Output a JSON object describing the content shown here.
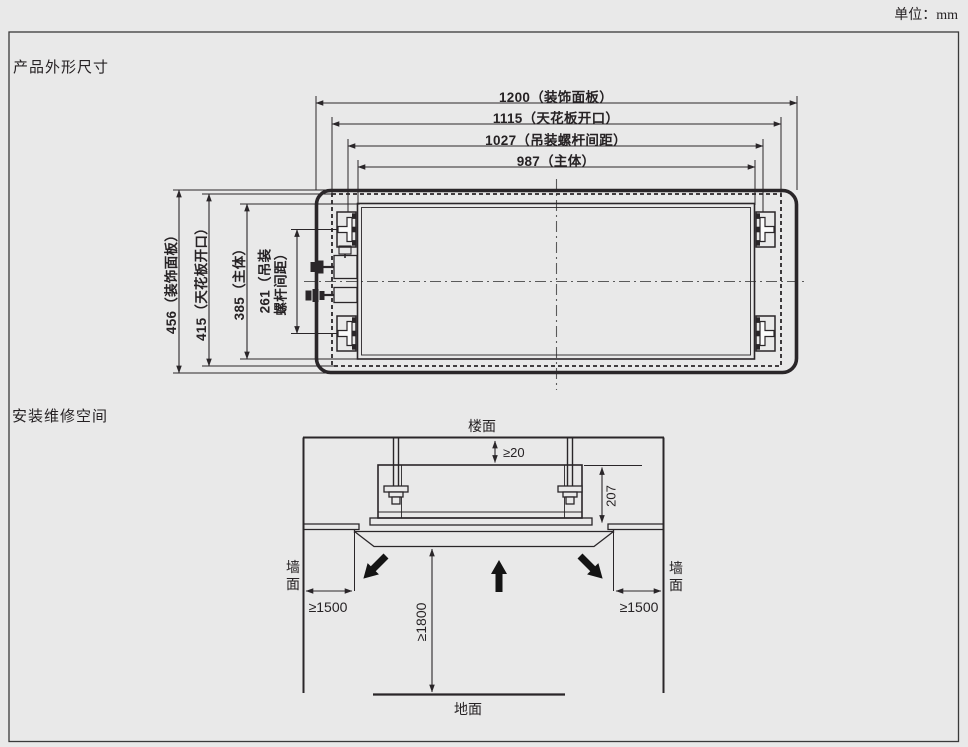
{
  "unit_note": "单位：mm",
  "outline_section": {
    "title": "产品外形尺寸",
    "horizontal_dims": {
      "panel": "1200（装饰面板）",
      "ceiling_opening": "1115（天花板开口）",
      "screw_pitch": "1027（吊装螺杆间距）",
      "body": "987（主体）"
    },
    "vertical_dims": {
      "panel": "456（装饰面板）",
      "ceiling_opening": "415（天花板开口）",
      "body": "385（主体）",
      "screw_pitch_line1": "261（吊装",
      "screw_pitch_line2": "螺杆间距）"
    }
  },
  "service_section": {
    "title": "安装维修空间",
    "labels": {
      "floor_above": "楼面",
      "wall_left": "墙面",
      "wall_right": "墙面",
      "ground": "地面"
    },
    "dims": {
      "slab_gap": "≥20",
      "unit_height": "207",
      "side_left": "≥1500",
      "side_right": "≥1500",
      "floor_clearance": "≥1800"
    }
  },
  "colors": {
    "line": "#2a2629",
    "background": "#e9e9e9"
  }
}
